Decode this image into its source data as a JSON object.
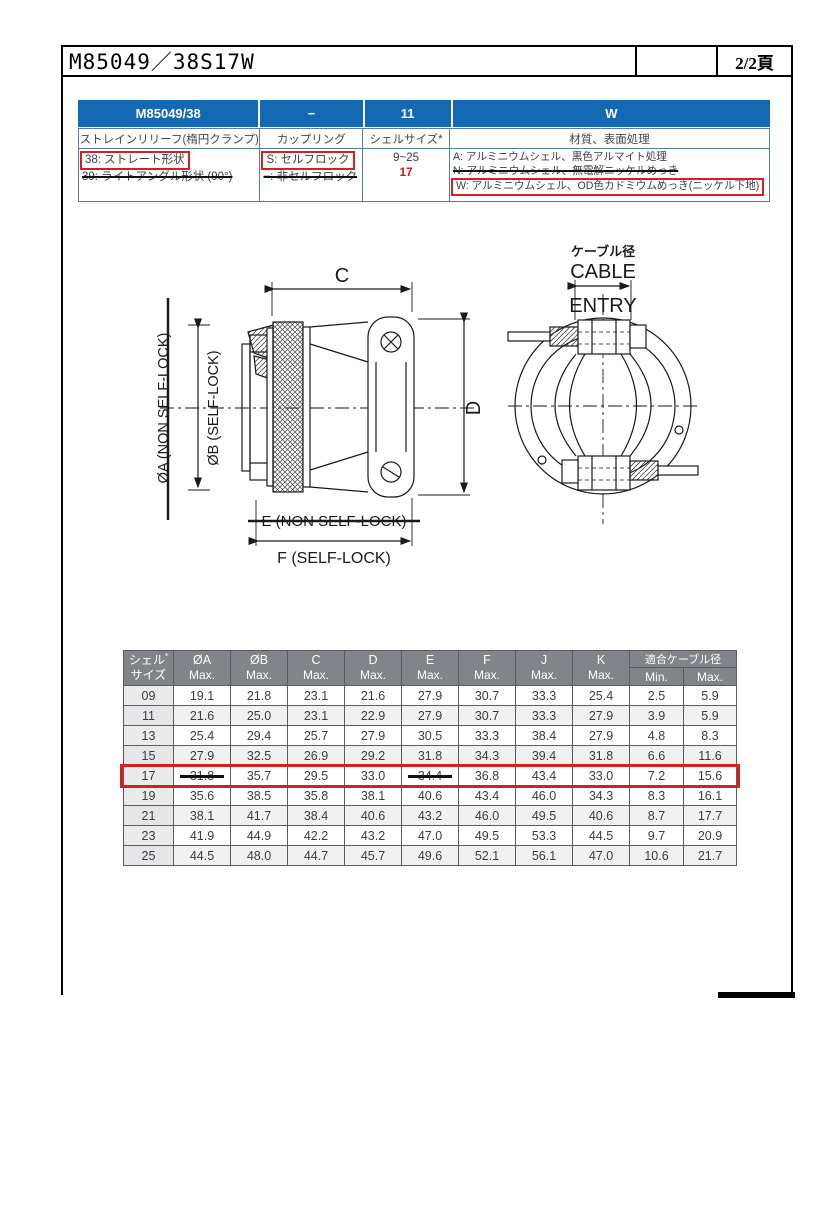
{
  "page": {
    "title": "M85049／38S17W",
    "page_label": "2/2頁"
  },
  "colors": {
    "header_blue": "#1568b3",
    "annotation_red": "#d42020",
    "table_header_gray": "#818488"
  },
  "selector_table": {
    "columns": [
      {
        "code": "M85049/38",
        "label": "ストレインリリーフ(楕円クランプ)",
        "options": [
          {
            "text": "38: ストレート形状",
            "boxed": true
          },
          {
            "text": "39: ライトアングル形状 (90°)",
            "struck": true
          }
        ]
      },
      {
        "code": "−",
        "label": "カップリング",
        "options": [
          {
            "text": "S: セルフロック",
            "boxed": true
          },
          {
            "text": "−: 非セルフロック",
            "struck": true
          }
        ]
      },
      {
        "code": "11",
        "label": "シェルサイズ*",
        "options": [
          {
            "text": "9~25",
            "center": true
          },
          {
            "text": "17",
            "red": true,
            "center": true
          }
        ]
      },
      {
        "code": "W",
        "label": "材質、表面処理",
        "small": true,
        "options": [
          {
            "text": "A: アルミニウムシェル、黒色アルマイト処理"
          },
          {
            "text": "N: アルミニウムシェル、無電解ニッケルめっき",
            "struck": true
          },
          {
            "text": "W: アルミニウムシェル、OD色カドミウムめっき(ニッケル下地)",
            "boxed": true
          }
        ]
      }
    ]
  },
  "drawing": {
    "labels": {
      "dim_c": "C",
      "dim_d": "D",
      "dia_a": "ØA (NON SELF-LOCK)",
      "dia_b": "ØB (SELF-LOCK)",
      "dim_e": "E (NON SELF-LOCK)",
      "dim_f": "F (SELF-LOCK)",
      "cable_dia_jp": "ケーブル径",
      "cable_line1": "CABLE",
      "cable_line2": "ENTRY"
    }
  },
  "dimension_table": {
    "header": {
      "shell_line1": "シェル",
      "shell_asterisk": "*",
      "shell_line2": "サイズ",
      "max_label": "Max.",
      "dims": [
        "ØA",
        "ØB",
        "C",
        "D",
        "E",
        "F",
        "J",
        "K"
      ],
      "cable_group": "適合ケーブル径",
      "cable_min": "Min.",
      "cable_max": "Max."
    },
    "rows": [
      {
        "size": "09",
        "values": [
          "19.1",
          "21.8",
          "23.1",
          "21.6",
          "27.9",
          "30.7",
          "33.3",
          "25.4",
          "2.5",
          "5.9"
        ]
      },
      {
        "size": "11",
        "values": [
          "21.6",
          "25.0",
          "23.1",
          "22.9",
          "27.9",
          "30.7",
          "33.3",
          "27.9",
          "3.9",
          "5.9"
        ],
        "shaded": true
      },
      {
        "size": "13",
        "values": [
          "25.4",
          "29.4",
          "25.7",
          "27.9",
          "30.5",
          "33.3",
          "38.4",
          "27.9",
          "4.8",
          "8.3"
        ]
      },
      {
        "size": "15",
        "values": [
          "27.9",
          "32.5",
          "26.9",
          "29.2",
          "31.8",
          "34.3",
          "39.4",
          "31.8",
          "6.6",
          "11.6"
        ],
        "shaded": true
      },
      {
        "size": "17",
        "values": [
          "31.8",
          "35.7",
          "29.5",
          "33.0",
          "34.4",
          "36.8",
          "43.4",
          "33.0",
          "7.2",
          "15.6"
        ],
        "boxed": true,
        "struck": [
          0,
          4
        ]
      },
      {
        "size": "19",
        "values": [
          "35.6",
          "38.5",
          "35.8",
          "38.1",
          "40.6",
          "43.4",
          "46.0",
          "34.3",
          "8.3",
          "16.1"
        ]
      },
      {
        "size": "21",
        "values": [
          "38.1",
          "41.7",
          "38.4",
          "40.6",
          "43.2",
          "46.0",
          "49.5",
          "40.6",
          "8.7",
          "17.7"
        ],
        "shaded": true
      },
      {
        "size": "23",
        "values": [
          "41.9",
          "44.9",
          "42.2",
          "43.2",
          "47.0",
          "49.5",
          "53.3",
          "44.5",
          "9.7",
          "20.9"
        ]
      },
      {
        "size": "25",
        "values": [
          "44.5",
          "48.0",
          "44.7",
          "45.7",
          "49.6",
          "52.1",
          "56.1",
          "47.0",
          "10.6",
          "21.7"
        ],
        "shaded": true
      }
    ]
  }
}
